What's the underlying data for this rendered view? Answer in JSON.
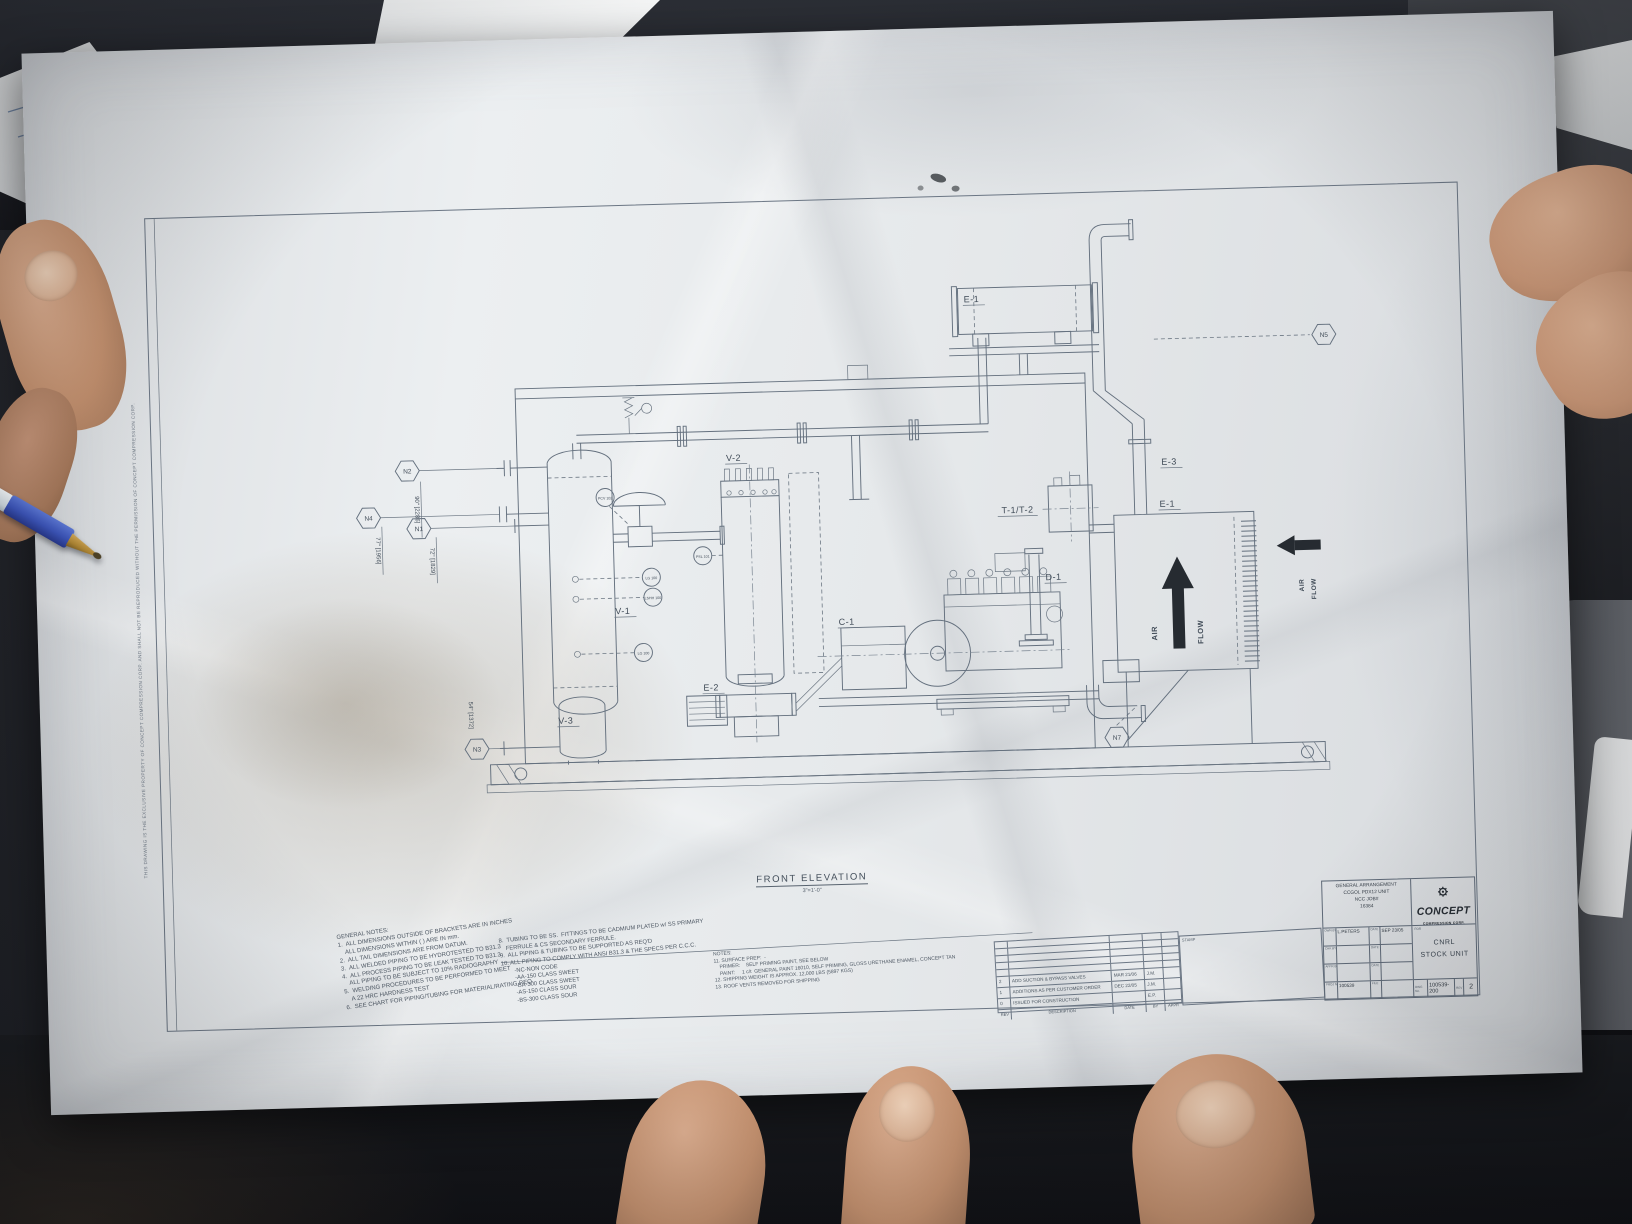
{
  "colors": {
    "pen_blue": "#3c55bb",
    "paper": "#e8eaec",
    "drawing_line": "#64707e",
    "logo_black": "#262c33"
  },
  "drawing": {
    "view_title": "FRONT ELEVATION",
    "view_scale": "3\"=1'-0\"",
    "edge_note": "THIS DRAWING IS THE EXCLUSIVE PROPERTY OF CONCEPT COMPRESSION CORP. AND SHALL NOT BE REPRODUCED WITHOUT THE PERMISSION OF CONCEPT COMPRESSION CORP.",
    "tags": {
      "v1": "V-1",
      "v2": "V-2",
      "v3": "V-3",
      "c1": "C-1",
      "d1": "D-1",
      "e1_top": "E-1",
      "e1_cooler": "E-1",
      "e2": "E-2",
      "e3": "E-3",
      "t1t2": "T-1/T-2"
    },
    "nozzles": {
      "n1": "N1",
      "n2": "N2",
      "n3": "N3",
      "n4": "N4",
      "n5": "N5",
      "n7": "N7"
    },
    "dimensions": {
      "d90": "90\" [2286]",
      "d77": "77\" [1956]",
      "d72": "72\" [1829]",
      "d54": "54\" [1372]"
    },
    "instruments": {
      "pcv": "PCV 102",
      "psl": "PSL 101",
      "lg1": "LG 100",
      "lshh": "LSHH 100",
      "lg2": "LG 100"
    },
    "airflow": {
      "up_air": "AIR",
      "up_flow": "FLOW",
      "right_air": "AIR",
      "right_flow": "FLOW"
    }
  },
  "notes_general": {
    "lines": [
      "GENERAL NOTES:",
      "1.  ALL DIMENSIONS OUTSIDE OF BRACKETS ARE IN INCHES",
      "    ALL DIMENSIONS WITHIN ( ) ARE IN mm.",
      "2.  ALL TAIL DIMENSIONS ARE FROM DATUM.",
      "3.  ALL WELDED PIPING TO BE HYDROTESTED TO B31.3",
      "4.  ALL PROCESS PIPING TO BE LEAK TESTED TO B31.3",
      "    ALL PIPING TO BE SUBJECT TO 10% RADIOGRAPHY",
      "5.  WELDING PROCEDURES TO BE PERFORMED TO MEET",
      "    A 22 HRC HARDNESS TEST",
      "6.  SEE CHART FOR PIPING/TUBING FOR MATERIAL/RATING REQ."
    ]
  },
  "notes_piping": {
    "lines": [
      "8.  TUBING TO BE SS.  FITTINGS TO BE CADMIUM PLATED w/ SS PRIMARY",
      "    FERRULE & CS SECONDARY FERRULE.",
      "9.  ALL PIPING & TUBING TO BE SUPPORTED AS REQ'D",
      "10. ALL PIPING TO COMPLY WITH ANSI B31.3 & THE SPECS PER C.C.C.",
      "        -NC-NON CODE",
      "        -AA-150 CLASS SWEET",
      "        -BA-300 CLASS SWEET",
      "        -AS-150 CLASS SOUR",
      "        -BS-300 CLASS SOUR"
    ]
  },
  "notes_surface": {
    "lines": [
      "NOTES:",
      "11. SURFACE PREP:  -",
      "    PRIMER:    SELF PRIMING PAINT, SEE BELOW",
      "    PAINT:     1 c/t  GENERAL PAINT 16010, SELF PRIMING, GLOSS URETHANE ENAMEL, CONCEPT TAN",
      "12. SHIPPING WEIGHT IS APPROX. 12,000 LBS (5897 KGS)",
      "13. ROOF VENTS REMOVED FOR SHIPPING"
    ]
  },
  "revision_table": {
    "stamp_label": "STAMP",
    "header": {
      "rev": "REV",
      "description": "DESCRIPTION",
      "date": "DATE",
      "by": "BY",
      "appr": "APPR"
    },
    "rows": [
      {
        "rev": "2",
        "description": "ADD SUCTION & BYPASS VALVES",
        "date": "MAR 21/06",
        "by": "J.M.",
        "appr": ""
      },
      {
        "rev": "1",
        "description": "ADDITIONS AS PER CUSTOMER ORDER",
        "date": "DEC 22/05",
        "by": "J.M.",
        "appr": ""
      },
      {
        "rev": "0",
        "description": "ISSUED FOR CONSTRUCTION",
        "date": "",
        "by": "E.P.",
        "appr": ""
      }
    ]
  },
  "title_block": {
    "project_lines": [
      "GENERAL ARRANGEMENT",
      "CCGOL PDX12 UNIT",
      "NCC JOB#",
      "16384"
    ],
    "company_name": "CONCEPT",
    "company_sub": "COMPRESSION CORP.",
    "for_label": "FOR",
    "client_line1": "CNRL",
    "client_line2": "STOCK UNIT",
    "sig_rows": [
      {
        "label": "DWN BY",
        "value": "L.PETERS",
        "date_label": "DATE",
        "date_value": "SEP 23/05"
      },
      {
        "label": "CHK BY",
        "value": "",
        "date_label": "DATE",
        "date_value": ""
      },
      {
        "label": "APPR BY",
        "value": "",
        "date_label": "DATE",
        "date_value": ""
      },
      {
        "label": "PROJ No.",
        "value": "100539",
        "date_label": "FILE",
        "date_value": ""
      }
    ],
    "dwg_label": "DWG No.",
    "dwg_number": "100539-200",
    "rev_label": "REV",
    "rev_value": "2"
  }
}
